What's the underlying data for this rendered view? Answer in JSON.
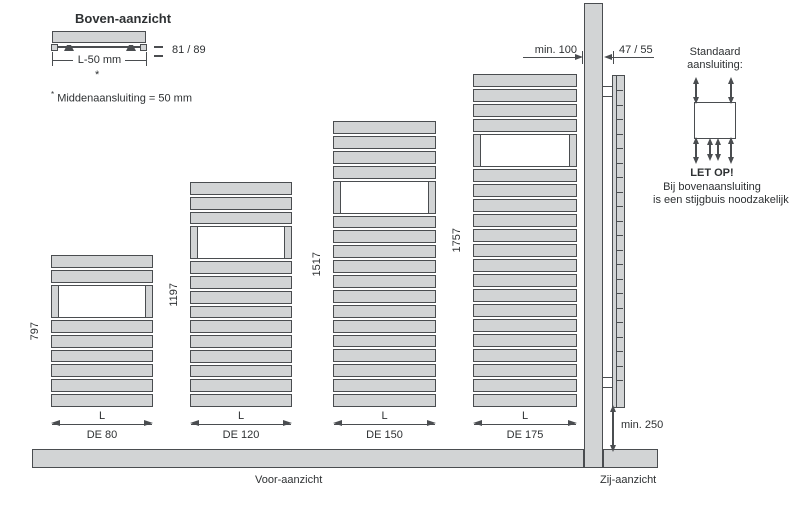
{
  "top_view": {
    "title": "Boven-aanzicht",
    "width_dimension": "L-50 mm",
    "footnote_marker": "*",
    "depth_dimension": "81 / 89",
    "footnote_text": "Middenaansluiting = 50 mm"
  },
  "front_view": {
    "caption": "Voor-aanzicht",
    "width_label": "L",
    "radiators": [
      {
        "model": "DE 80",
        "height": "797",
        "top_slats": 2,
        "bottom_slats": 6
      },
      {
        "model": "DE 120",
        "height": "1197",
        "top_slats": 3,
        "bottom_slats": 10
      },
      {
        "model": "DE 150",
        "height": "1517",
        "top_slats": 4,
        "bottom_slats": 13
      },
      {
        "model": "DE 175",
        "height": "1757",
        "top_slats": 4,
        "bottom_slats": 16
      }
    ]
  },
  "side_view": {
    "caption": "Zij-aanzicht",
    "top_clearance": "min. 100",
    "depth_dimension": "47 / 55",
    "bottom_clearance": "min. 250"
  },
  "connection_info": {
    "heading_line1": "Standaard",
    "heading_line2": "aansluiting:",
    "warning_title": "LET OP!",
    "warning_line1": "Bij bovenaansluiting",
    "warning_line2": "is een stijgbuis noodzakelijk"
  },
  "colors": {
    "panel_fill": "#d2d4d5",
    "outline": "#4a4d50",
    "text": "#2e3133"
  }
}
